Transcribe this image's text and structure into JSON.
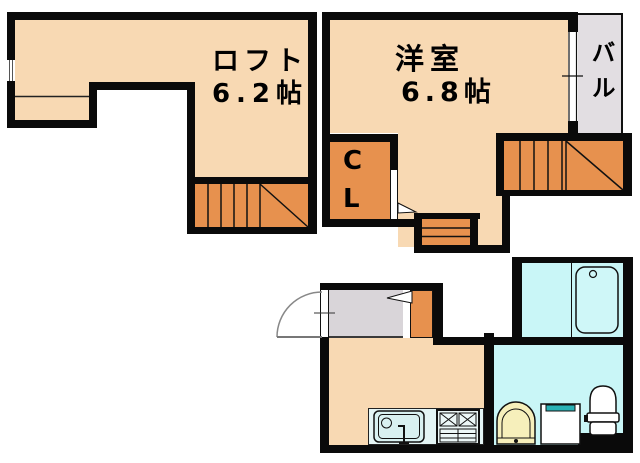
{
  "plan_title": "apartment-floor-plan",
  "rooms": {
    "loft": {
      "label": "ロフト",
      "size": "6.2帖"
    },
    "western_room": {
      "label": "洋室",
      "size": "6.8帖"
    },
    "balcony": {
      "label": "バル"
    },
    "closet": {
      "label": "CL"
    }
  },
  "fixtures": [
    "kitchen-sink",
    "gas-stove",
    "washbasin",
    "washing-machine",
    "toilet",
    "bathtub",
    "entrance-door",
    "closet-door",
    "stairs-upper-left",
    "stairs-upper-right",
    "small-steps",
    "window"
  ],
  "colors": {
    "wall": "#0a0a0a",
    "floor": "#f8d9b3",
    "stair": "#e7914e",
    "balcony": "#e2dee2",
    "genkan": "#d9d5d9",
    "water": "#c9f6f7",
    "counter": "#e4f5f5",
    "basin": "#f6efbb",
    "teal": "#29b1b5",
    "line": "#111111"
  }
}
